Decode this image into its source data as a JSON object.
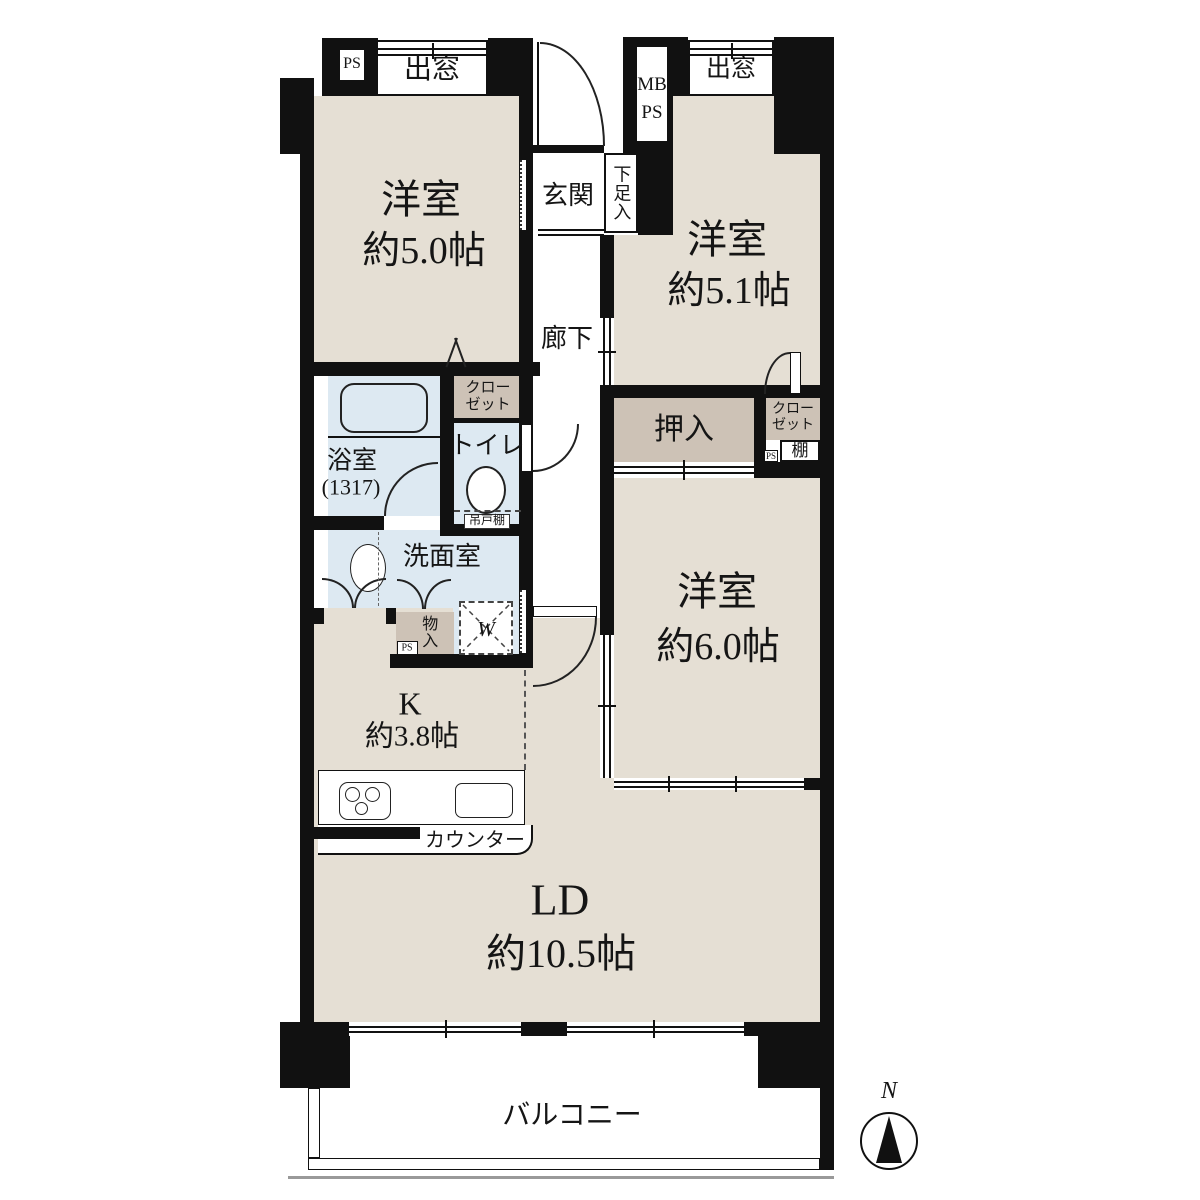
{
  "rooms": {
    "bedroom_nw": {
      "name": "洋室",
      "size": "約5.0帖"
    },
    "bedroom_ne": {
      "name": "洋室",
      "size": "約5.1帖"
    },
    "bedroom_e": {
      "name": "洋室",
      "size": "約6.0帖"
    },
    "kitchen": {
      "name": "K",
      "size": "約3.8帖"
    },
    "living": {
      "name": "LD",
      "size": "約10.5帖"
    },
    "balcony": {
      "name": "バルコニー"
    },
    "entrance": {
      "name": "玄関"
    },
    "corridor": {
      "name": "廊下"
    },
    "bath": {
      "name": "浴室",
      "size": "(1317)"
    },
    "washroom": {
      "name": "洗面室"
    },
    "toilet": {
      "name": "トイレ"
    }
  },
  "storage": {
    "shoe_cabinet": "下足入",
    "closet_nw": "クローゼット",
    "closet_ne": "クローゼット",
    "oshiire": "押入",
    "monoire": "物入",
    "shelf": "棚",
    "hanging_cupboard": "吊戸棚"
  },
  "fixtures": {
    "counter": "カウンター",
    "washer": "W",
    "bay_window_nw": "出窓",
    "bay_window_ne": "出窓"
  },
  "shafts": {
    "ps_nw": "PS",
    "mb_ne": "MB",
    "ps_ne": "PS",
    "ps_mid": "PS",
    "ps_e": "PS"
  },
  "compass": {
    "north": "N"
  },
  "colors": {
    "room": "#e5dfd4",
    "wet": "#dde9f2",
    "closet": "#cdc2b6",
    "wall": "#111111"
  }
}
